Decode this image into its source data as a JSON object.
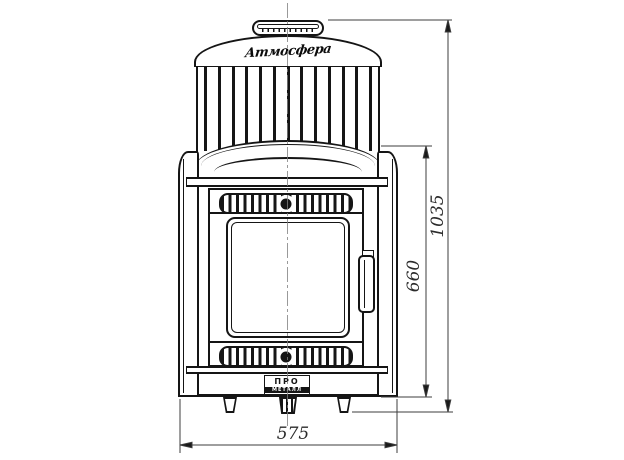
{
  "drawing": {
    "description": "Front-view dimensioned technical drawing of a wood-fired sauna stove with convector cage, glass firebox door and vent grilles",
    "brand_script": "Атмосфера",
    "brand_plate": {
      "top": "ПРО",
      "bottom": "МЕТАЛЛ"
    },
    "dimensions": {
      "overall_height": "1035",
      "body_height": "660",
      "overall_width": "575"
    },
    "colors": {
      "line": "#151515",
      "dimension_line": "#3c3c3c",
      "centerline": "#808080",
      "background": "#ffffff"
    }
  }
}
